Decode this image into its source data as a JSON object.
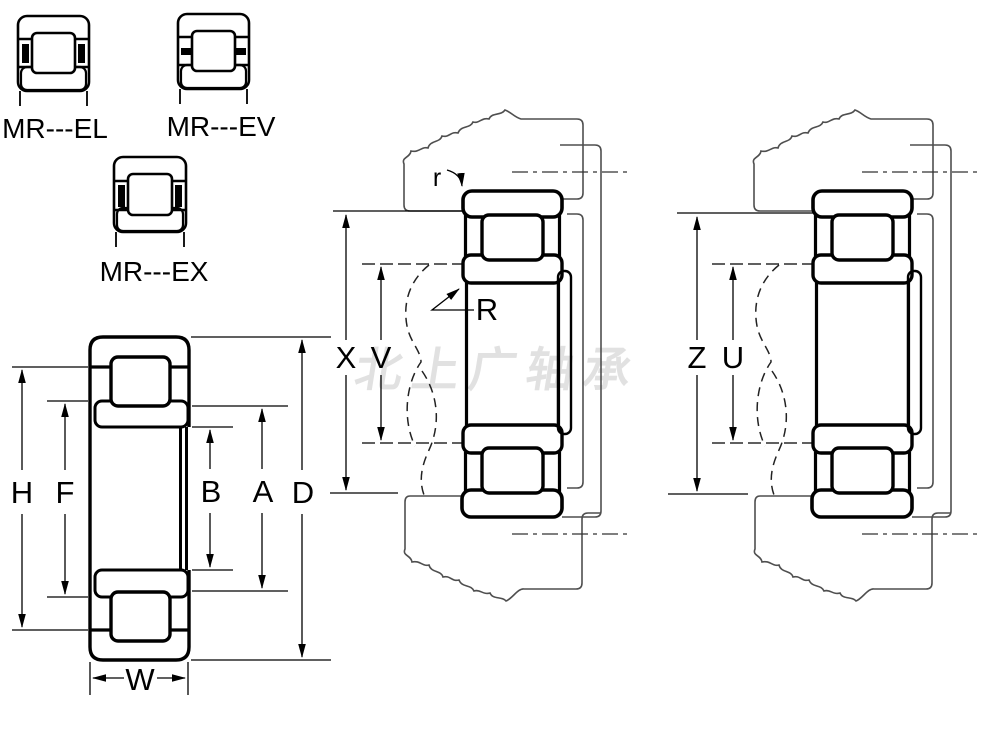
{
  "watermark": {
    "text": "北上广轴承"
  },
  "type_icons": {
    "el": {
      "label": "MR---EL"
    },
    "ev": {
      "label": "MR---EV"
    },
    "ex": {
      "label": "MR---EX"
    }
  },
  "left_view": {
    "dim_labels": {
      "flange_height_h": "H",
      "rib_diameter_f": "F",
      "bore_width_b": "B",
      "raceway_diameter_a": "A",
      "outer_diameter_d": "D",
      "ring_width_w": "W"
    }
  },
  "middle_view": {
    "dim_labels": {
      "housing_abutment_x": "X",
      "shaft_abutment_v": "V"
    },
    "callouts": {
      "corner_radius": "r",
      "fillet_radius": "R"
    }
  },
  "right_view": {
    "dim_labels": {
      "housing_abutment_z": "Z",
      "shaft_abutment_u": "U"
    }
  },
  "colors": {
    "ink": "#000000",
    "housing_line": "#4f4f4f",
    "dimension_line": "#000000",
    "watermark": "#e1e1e1",
    "background": "#ffffff"
  }
}
